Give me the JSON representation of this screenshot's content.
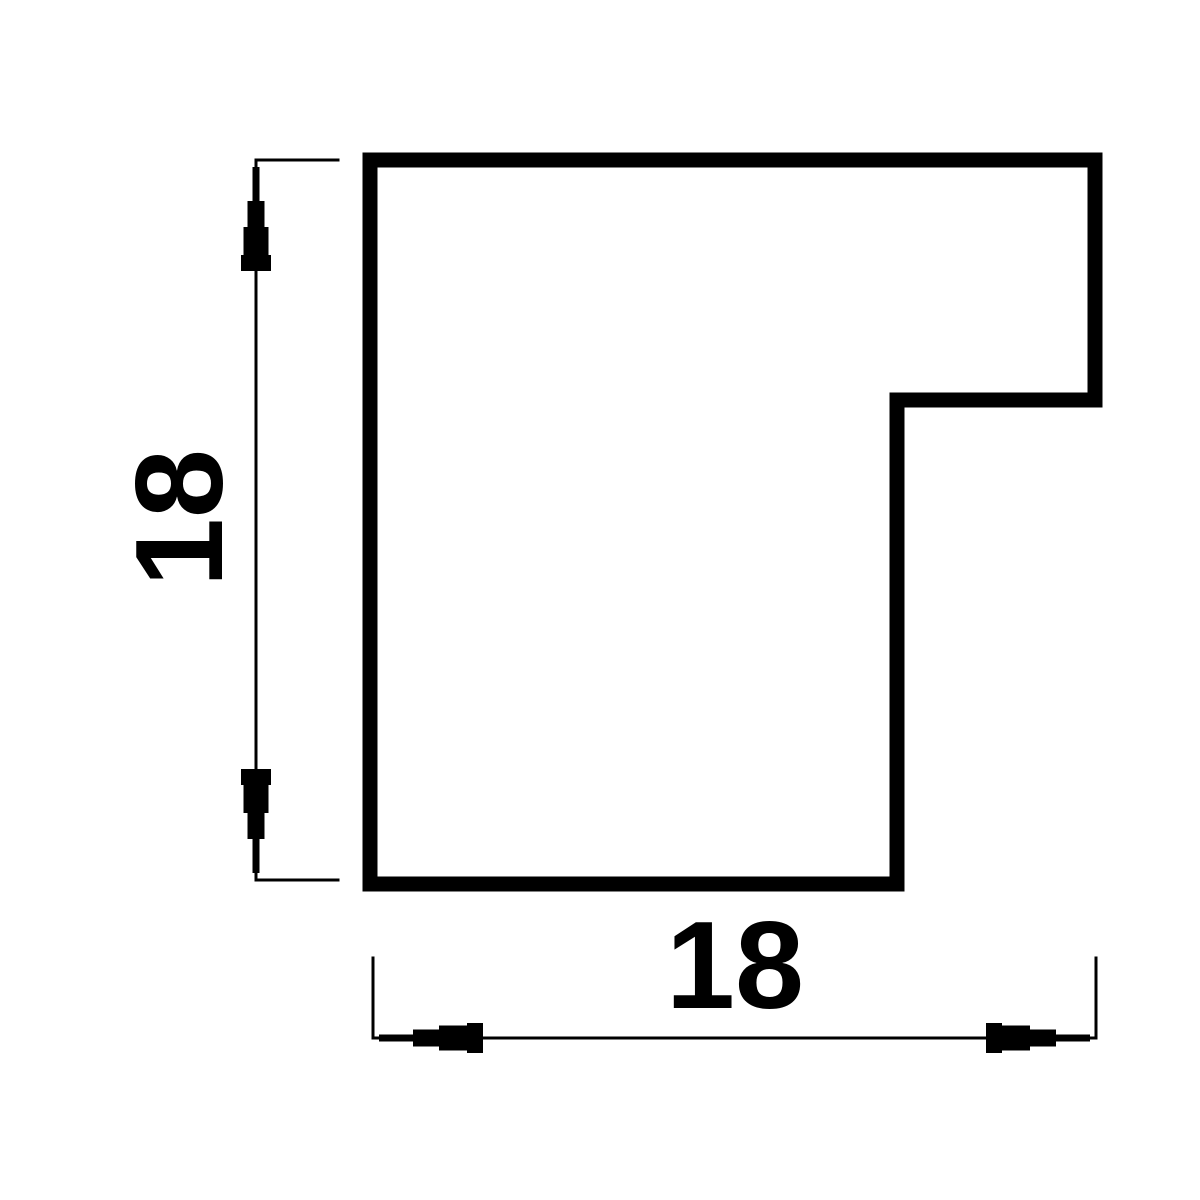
{
  "drawing": {
    "description": "Technical cross-section drawing of an L-shaped frame moulding profile with rebate notch",
    "labels": {
      "vertical_dimension_value": "18",
      "horizontal_dimension_value": "18"
    },
    "colors": {
      "line": "#000000",
      "background": "#ffffff"
    }
  }
}
